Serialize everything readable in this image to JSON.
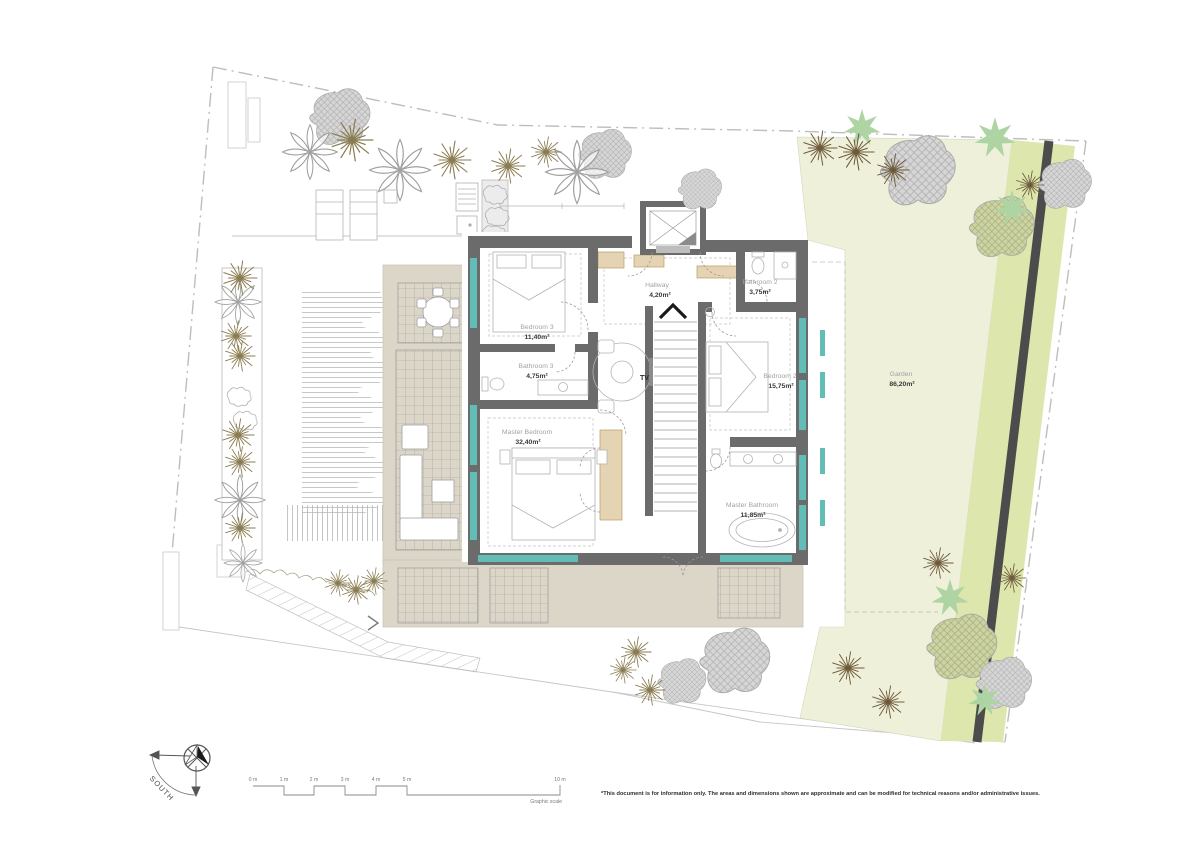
{
  "rooms": {
    "bedroom3": {
      "name": "Bedroom 3",
      "area": "11,40m²"
    },
    "bathroom3": {
      "name": "Bathroom 3",
      "area": "4,75m²"
    },
    "hallway": {
      "name": "Hallway",
      "area": "4,20m²"
    },
    "bathroom2": {
      "name": "Bathroom 2",
      "area": "3,75m²"
    },
    "bedroom2": {
      "name": "Bedroom 2",
      "area": "15,75m²"
    },
    "master_bedroom": {
      "name": "Master Bedroom",
      "area": "32,40m²"
    },
    "master_bathroom": {
      "name": "Master Bathroom",
      "area": "11,85m²"
    },
    "garden": {
      "name": "Garden",
      "area": "86,20m²"
    }
  },
  "labels": {
    "tv": "TV"
  },
  "compass": {
    "direction": "SOUTH"
  },
  "scale": {
    "ticks": [
      "0 m",
      "1 m",
      "2 m",
      "3 m",
      "4 m",
      "5 m",
      "10 m"
    ],
    "caption": "Graphic scale"
  },
  "footer": {
    "disclaimer": "*This document is for information only. The areas and dimensions shown are approximate and can be modified for technical reasons and/or administrative issues."
  },
  "colors": {
    "wall": "#6b6b6b",
    "terrace": "#dcd6c8",
    "garden": "#eef0da",
    "garden_strip": "#dde7ad",
    "path": "#4c4c4c",
    "window": "#62bdb7"
  }
}
